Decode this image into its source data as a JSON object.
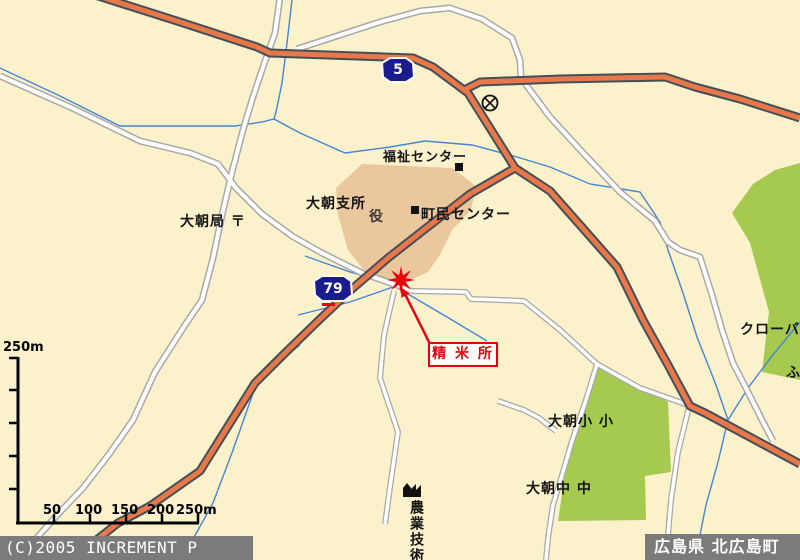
{
  "title_bars": {
    "copyright": "(C)2005 INCREMENT P CORP.",
    "region": "広島県 北広島町"
  },
  "shields": {
    "route5": "5",
    "route79": "79"
  },
  "callout": {
    "text": "精 米 所"
  },
  "labels": {
    "fukushi_center": "福祉センター",
    "oasa_branch": "大朝支所",
    "yakuba": "役",
    "chomin_center": "町民センター",
    "oasa_post_office": "大朝局 〒",
    "clover": "クローバ",
    "fu": "ふ",
    "oasa_elementary": "大朝小 小",
    "oasa_junior_high": "大朝中 中",
    "agri_tech": "農業技術"
  },
  "scale_bar": {
    "top_label": "250m",
    "ticks": [
      "50",
      "100",
      "150",
      "200",
      "250m"
    ]
  },
  "icons": {
    "police_box": "circle-with-x",
    "factory": "factory-silhouette",
    "destination_marker": "red-8-point-star",
    "facility_marker": "black-square"
  },
  "colors": {
    "background": "#fbf2cc",
    "road_orange": "#e8784a",
    "road_casing": "#454f57",
    "minor_road_casing": "#a8a8a8",
    "water": "#4585d5",
    "green_area": "#a6c94f",
    "public_area_beige": "#eac79c",
    "shield_navy": "#1a1c8e",
    "marker_red": "#e8000d",
    "bar_gray": "#7b7b7b"
  }
}
